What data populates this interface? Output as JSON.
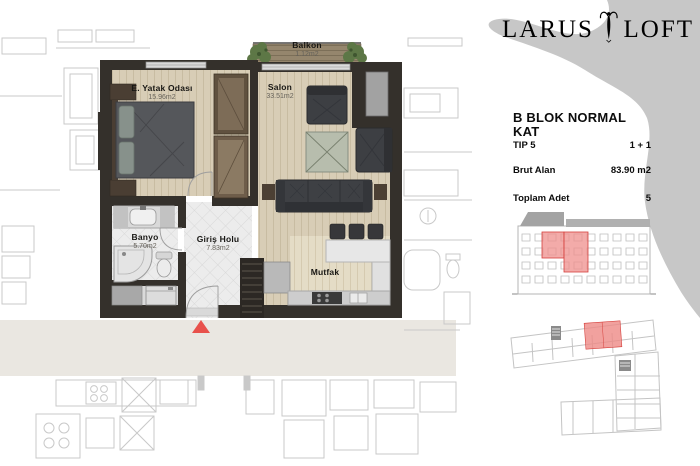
{
  "brand": {
    "word_left": "LARUS",
    "word_right": "LOFT"
  },
  "info": {
    "title": "B BLOK NORMAL KAT",
    "rows": [
      {
        "label": "TIP 5",
        "value": "1 + 1"
      },
      {
        "label": "Brut Alan",
        "value": "83.90 m2"
      },
      {
        "label": "Toplam Adet",
        "value": "5"
      }
    ]
  },
  "plan": {
    "rooms": [
      {
        "name": "Balkon",
        "area": "1.12m2"
      },
      {
        "name": "E. Yatak Odası",
        "area": "15.96m2"
      },
      {
        "name": "Salon",
        "area": "33.51m2"
      },
      {
        "name": "Banyo",
        "area": "5.70m2"
      },
      {
        "name": "Giriş Holu",
        "area": "7.83m2"
      },
      {
        "name": "Mutfak"
      }
    ]
  },
  "colors": {
    "wall_dark": "#34302b",
    "wood_floor": "#d8cdb6",
    "tile_floor": "#ececec",
    "accent_red": "#e8514b",
    "highlight_pink": "#ef8f8c",
    "silhouette_gray": "#c7c7c7",
    "corridor_gray": "#eae7e1"
  }
}
